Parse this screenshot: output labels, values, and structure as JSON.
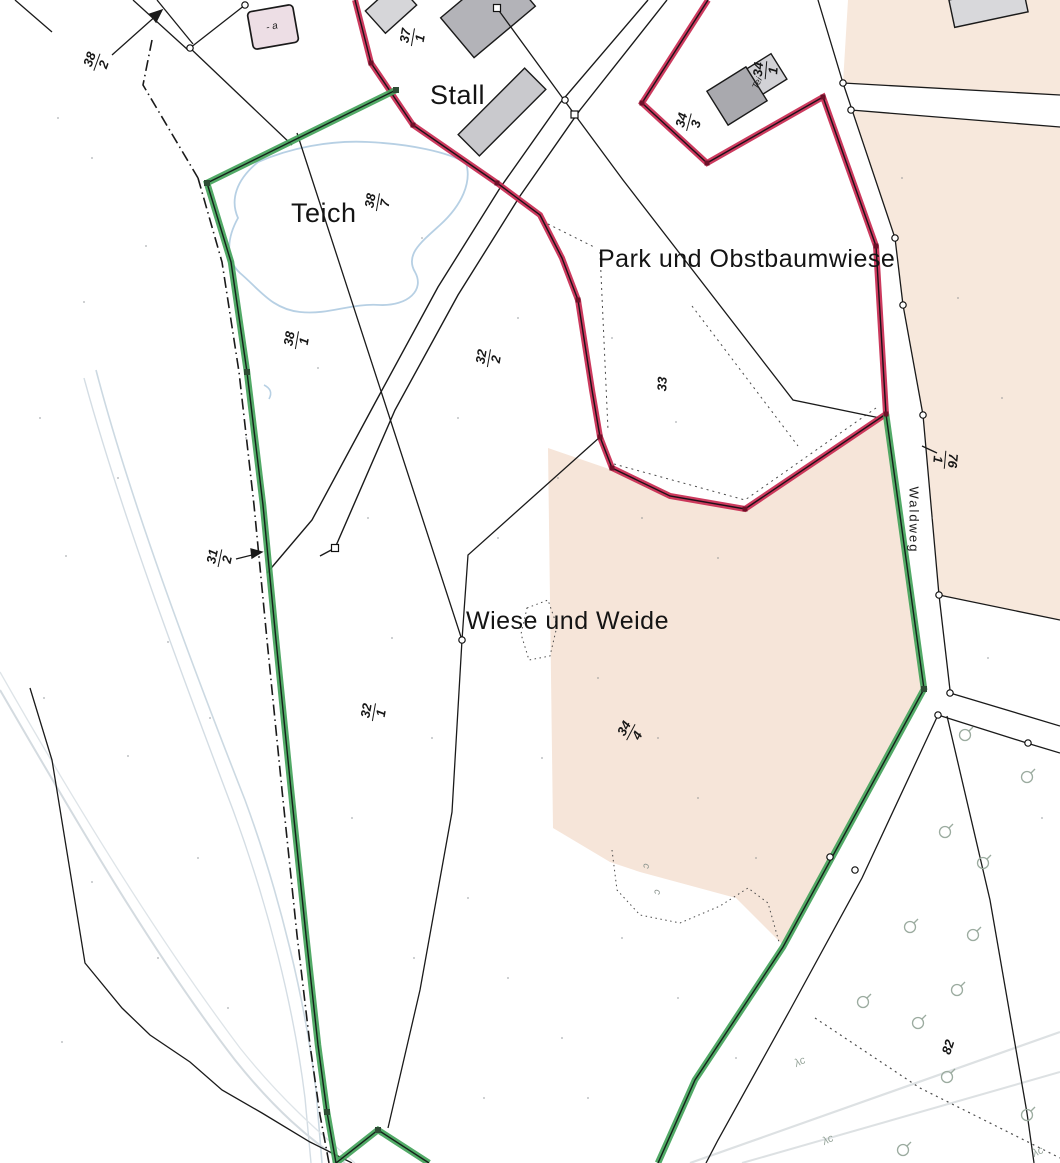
{
  "map": {
    "area_labels": {
      "stall": "Stall",
      "teich": "Teich",
      "park": "Park und Obstbaumwiese",
      "wiese": "Wiese und Weide",
      "waldweg": "Waldweg"
    },
    "parcels": {
      "p382": {
        "num": "38",
        "den": "2"
      },
      "p371": {
        "num": "37",
        "den": "1"
      },
      "p341": {
        "num": "34",
        "den": "1"
      },
      "p343": {
        "num": "34",
        "den": "3"
      },
      "p387": {
        "num": "38",
        "den": "7"
      },
      "p381": {
        "num": "38",
        "den": "1"
      },
      "p322": {
        "num": "32",
        "den": "2"
      },
      "p33": {
        "text": "33"
      },
      "p312": {
        "num": "31",
        "den": "2"
      },
      "p761": {
        "num": "76",
        "den": "1"
      },
      "p321": {
        "num": "32",
        "den": "1"
      },
      "p344": {
        "num": "34",
        "den": "4"
      },
      "p82": {
        "text": "82"
      }
    },
    "building_labels": {
      "a_label": "- a",
      "tei_label": "Tei"
    },
    "symbols": {
      "conifer": "λc",
      "vegetation_c": "c"
    },
    "colors": {
      "boundary_red": "#c82950",
      "boundary_green": "#43a35a",
      "area_peach_east": "#f7e8dc",
      "area_peach_center": "#f6e5d9",
      "water_blue": "#b7d0e4",
      "building_gray": "#b3b3b8",
      "building_pink": "#eddee5"
    }
  }
}
